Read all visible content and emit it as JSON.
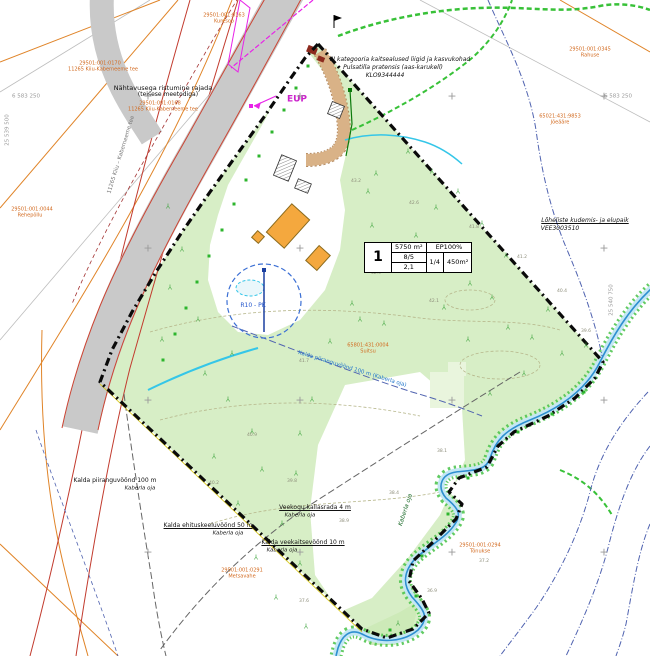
{
  "table": {
    "plot_no": "1",
    "area": "5750 m²",
    "ep": "EP100%",
    "floors": "8/5",
    "ratio": "1/4",
    "build_area": "450m²",
    "height": "2,1"
  },
  "colors": {
    "site_green": "#d7eec6",
    "road_gray": "#c9c9c9",
    "boundary_black": "#0a0a0a",
    "cadastral_orange": "#d2691e",
    "protection_red": "#c23b2e",
    "stream_blue": "#2e8fd0",
    "scrub_green": "#46c246",
    "magenta": "#cc22cc",
    "buffer_navy": "#5063b0",
    "building_orange": "#f4a83e"
  },
  "labels": [
    {
      "t": "Nähtavusega ristumine rajada",
      "x": 163,
      "y": 88,
      "s": 6.5,
      "c": "#111111"
    },
    {
      "t": "(teisese meetodiga)",
      "x": 168,
      "y": 95,
      "s": 6,
      "c": "#111111"
    },
    {
      "t": "29501:001:0168",
      "x": 160,
      "y": 104,
      "s": 5,
      "c": "#d2691e"
    },
    {
      "t": "11265 Kiiu-Kaberneeme tee",
      "x": 163,
      "y": 110,
      "s": 5,
      "c": "#d2691e"
    },
    {
      "t": "29501:001:0170",
      "x": 100,
      "y": 64,
      "s": 5,
      "c": "#d2691e"
    },
    {
      "t": "11265 Kiiu-Kaberneeme tee",
      "x": 103,
      "y": 70,
      "s": 5,
      "c": "#d2691e"
    },
    {
      "t": "11265 Kiiu – Kaberneeme tee",
      "x": 122,
      "y": 155,
      "s": 5.5,
      "c": "#777777",
      "r": -73
    },
    {
      "t": "29501:001:0044",
      "x": 32,
      "y": 210,
      "s": 5,
      "c": "#d2691e"
    },
    {
      "t": "Rehepõllu",
      "x": 30,
      "y": 216,
      "s": 5,
      "c": "#d2691e"
    },
    {
      "t": "29501:001:0163",
      "x": 224,
      "y": 16,
      "s": 5,
      "c": "#d2691e"
    },
    {
      "t": "Kuresoo",
      "x": 224,
      "y": 22,
      "s": 5,
      "c": "#d2691e"
    },
    {
      "t": "29501:001:0345",
      "x": 590,
      "y": 50,
      "s": 5,
      "c": "#d2691e"
    },
    {
      "t": "Rahuse",
      "x": 590,
      "y": 56,
      "s": 5,
      "c": "#d2691e"
    },
    {
      "t": "65021:431:9853",
      "x": 560,
      "y": 117,
      "s": 5,
      "c": "#d2691e"
    },
    {
      "t": "Jõeääre",
      "x": 560,
      "y": 123,
      "s": 5,
      "c": "#d2691e"
    },
    {
      "t": "III kategooria kaitsealused liigid ja kasvukohad",
      "x": 400,
      "y": 60,
      "s": 6,
      "c": "#111111",
      "i": 1
    },
    {
      "t": "Pulsatilla pratensis (aas-karukell)",
      "x": 393,
      "y": 68,
      "s": 6,
      "c": "#111111",
      "i": 1
    },
    {
      "t": "KLO9344444",
      "x": 385,
      "y": 76,
      "s": 6,
      "c": "#111111",
      "i": 1
    },
    {
      "t": "65801:431:0004",
      "x": 368,
      "y": 346,
      "s": 5,
      "c": "#d2691e"
    },
    {
      "t": "Suitsu",
      "x": 368,
      "y": 352,
      "s": 5,
      "c": "#d2691e"
    },
    {
      "t": "Kalda piiranguvöönd 100 m (Kaberla oja)",
      "x": 352,
      "y": 370,
      "s": 5.5,
      "c": "#2277cc",
      "r": 17
    },
    {
      "t": "Lõheliste kudemis- ja elupaik",
      "x": 585,
      "y": 221,
      "s": 6,
      "c": "#111111",
      "i": 1,
      "u": 1
    },
    {
      "t": "VEE3003510",
      "x": 560,
      "y": 229,
      "s": 6,
      "c": "#111111",
      "i": 1
    },
    {
      "t": "Kalda piiranguvöönd 100 m",
      "x": 115,
      "y": 481,
      "s": 6,
      "c": "#111111"
    },
    {
      "t": "Kaberla oja",
      "x": 140,
      "y": 489,
      "s": 5.5,
      "c": "#111111",
      "i": 1
    },
    {
      "t": "Kalda ehituskeeluvöönd 50 m",
      "x": 208,
      "y": 526,
      "s": 6,
      "c": "#111111",
      "u": 1
    },
    {
      "t": "Kaberla oja",
      "x": 228,
      "y": 534,
      "s": 5.5,
      "c": "#111111",
      "i": 1
    },
    {
      "t": "Veekogu kallasrada 4 m",
      "x": 315,
      "y": 508,
      "s": 6,
      "c": "#111111",
      "u": 1
    },
    {
      "t": "Kaberla oja",
      "x": 300,
      "y": 516,
      "s": 5.5,
      "c": "#111111",
      "i": 1
    },
    {
      "t": "Kalda veekaitsevöönd 10 m",
      "x": 303,
      "y": 543,
      "s": 6,
      "c": "#111111",
      "u": 1
    },
    {
      "t": "Kaberla oja",
      "x": 282,
      "y": 551,
      "s": 5.5,
      "c": "#111111",
      "i": 1
    },
    {
      "t": "29501:001:0291",
      "x": 242,
      "y": 571,
      "s": 5,
      "c": "#d2691e"
    },
    {
      "t": "Metsavahe",
      "x": 242,
      "y": 577,
      "s": 5,
      "c": "#d2691e"
    },
    {
      "t": "29501:001:0294",
      "x": 480,
      "y": 546,
      "s": 5,
      "c": "#d2691e"
    },
    {
      "t": "Tõnukse",
      "x": 480,
      "y": 552,
      "s": 5,
      "c": "#d2691e"
    },
    {
      "t": "EUP",
      "x": 297,
      "y": 100,
      "s": 9,
      "c": "#cc22cc",
      "b": 1
    },
    {
      "t": "R10 - PK",
      "x": 253,
      "y": 306,
      "s": 6,
      "c": "#2255cc"
    },
    {
      "t": "Kaberla oja",
      "x": 406,
      "y": 510,
      "s": 6,
      "c": "#1c6b2a",
      "r": -72,
      "i": 1
    },
    {
      "t": "6 583 250",
      "x": 618,
      "y": 97,
      "s": 5.5,
      "c": "#999999"
    },
    {
      "t": "6 583 250",
      "x": 26,
      "y": 97,
      "s": 5.5,
      "c": "#999999"
    },
    {
      "t": "25 539 500",
      "x": 8,
      "y": 130,
      "s": 5.5,
      "c": "#999999",
      "r": -90
    },
    {
      "t": "25 540 750",
      "x": 612,
      "y": 300,
      "s": 5.5,
      "c": "#999999",
      "r": -90
    }
  ],
  "glyphs": {
    "tree": "Y",
    "cross": "+"
  },
  "markers": {
    "trees": [
      [
        168,
        205
      ],
      [
        182,
        248
      ],
      [
        170,
        286
      ],
      [
        198,
        318
      ],
      [
        162,
        338
      ],
      [
        205,
        372
      ],
      [
        232,
        352
      ],
      [
        228,
        398
      ],
      [
        252,
        430
      ],
      [
        214,
        455
      ],
      [
        262,
        468
      ],
      [
        238,
        502
      ],
      [
        282,
        522
      ],
      [
        256,
        556
      ],
      [
        300,
        562
      ],
      [
        276,
        596
      ],
      [
        306,
        625
      ],
      [
        312,
        398
      ],
      [
        300,
        432
      ],
      [
        296,
        472
      ],
      [
        330,
        340
      ],
      [
        360,
        318
      ],
      [
        352,
        302
      ],
      [
        384,
        322
      ],
      [
        388,
        262
      ],
      [
        416,
        234
      ],
      [
        372,
        224
      ],
      [
        436,
        206
      ],
      [
        452,
        246
      ],
      [
        470,
        282
      ],
      [
        444,
        306
      ],
      [
        492,
        296
      ],
      [
        508,
        326
      ],
      [
        468,
        338
      ],
      [
        532,
        336
      ],
      [
        548,
        308
      ],
      [
        562,
        352
      ],
      [
        524,
        372
      ],
      [
        490,
        392
      ],
      [
        586,
        344
      ],
      [
        398,
        622
      ],
      [
        408,
        150
      ],
      [
        432,
        170
      ],
      [
        376,
        172
      ],
      [
        458,
        190
      ],
      [
        482,
        222
      ],
      [
        506,
        254
      ],
      [
        368,
        190
      ]
    ],
    "crosses": [
      [
        148,
        96
      ],
      [
        300,
        96
      ],
      [
        452,
        96
      ],
      [
        604,
        96
      ],
      [
        148,
        248
      ],
      [
        300,
        248
      ],
      [
        452,
        248
      ],
      [
        604,
        248
      ],
      [
        148,
        400
      ],
      [
        300,
        400
      ],
      [
        452,
        400
      ],
      [
        604,
        400
      ],
      [
        148,
        552
      ],
      [
        300,
        552
      ],
      [
        452,
        552
      ],
      [
        604,
        552
      ]
    ],
    "gdots": [
      [
        308,
        66
      ],
      [
        296,
        88
      ],
      [
        284,
        110
      ],
      [
        272,
        132
      ],
      [
        259,
        156
      ],
      [
        246,
        180
      ],
      [
        234,
        204
      ],
      [
        222,
        230
      ],
      [
        209,
        256
      ],
      [
        197,
        282
      ],
      [
        186,
        308
      ],
      [
        175,
        334
      ],
      [
        163,
        360
      ],
      [
        584,
        392
      ],
      [
        552,
        414
      ],
      [
        518,
        432
      ],
      [
        468,
        478
      ],
      [
        448,
        514
      ],
      [
        422,
        556
      ],
      [
        416,
        596
      ],
      [
        390,
        630
      ]
    ],
    "elevations": [
      {
        "x": 356,
        "y": 182,
        "t": "43.2"
      },
      {
        "x": 414,
        "y": 204,
        "t": "42.6"
      },
      {
        "x": 474,
        "y": 228,
        "t": "41.8"
      },
      {
        "x": 522,
        "y": 258,
        "t": "41.2"
      },
      {
        "x": 562,
        "y": 292,
        "t": "40.4"
      },
      {
        "x": 586,
        "y": 332,
        "t": "39.6"
      },
      {
        "x": 434,
        "y": 302,
        "t": "42.1"
      },
      {
        "x": 376,
        "y": 274,
        "t": "42.9"
      },
      {
        "x": 304,
        "y": 362,
        "t": "41.7"
      },
      {
        "x": 252,
        "y": 436,
        "t": "40.9"
      },
      {
        "x": 214,
        "y": 484,
        "t": "40.2"
      },
      {
        "x": 292,
        "y": 482,
        "t": "39.8"
      },
      {
        "x": 344,
        "y": 522,
        "t": "38.9"
      },
      {
        "x": 394,
        "y": 494,
        "t": "38.4"
      },
      {
        "x": 442,
        "y": 452,
        "t": "38.1"
      },
      {
        "x": 304,
        "y": 602,
        "t": "37.6"
      },
      {
        "x": 432,
        "y": 592,
        "t": "36.9"
      },
      {
        "x": 484,
        "y": 562,
        "t": "37.2"
      }
    ]
  }
}
